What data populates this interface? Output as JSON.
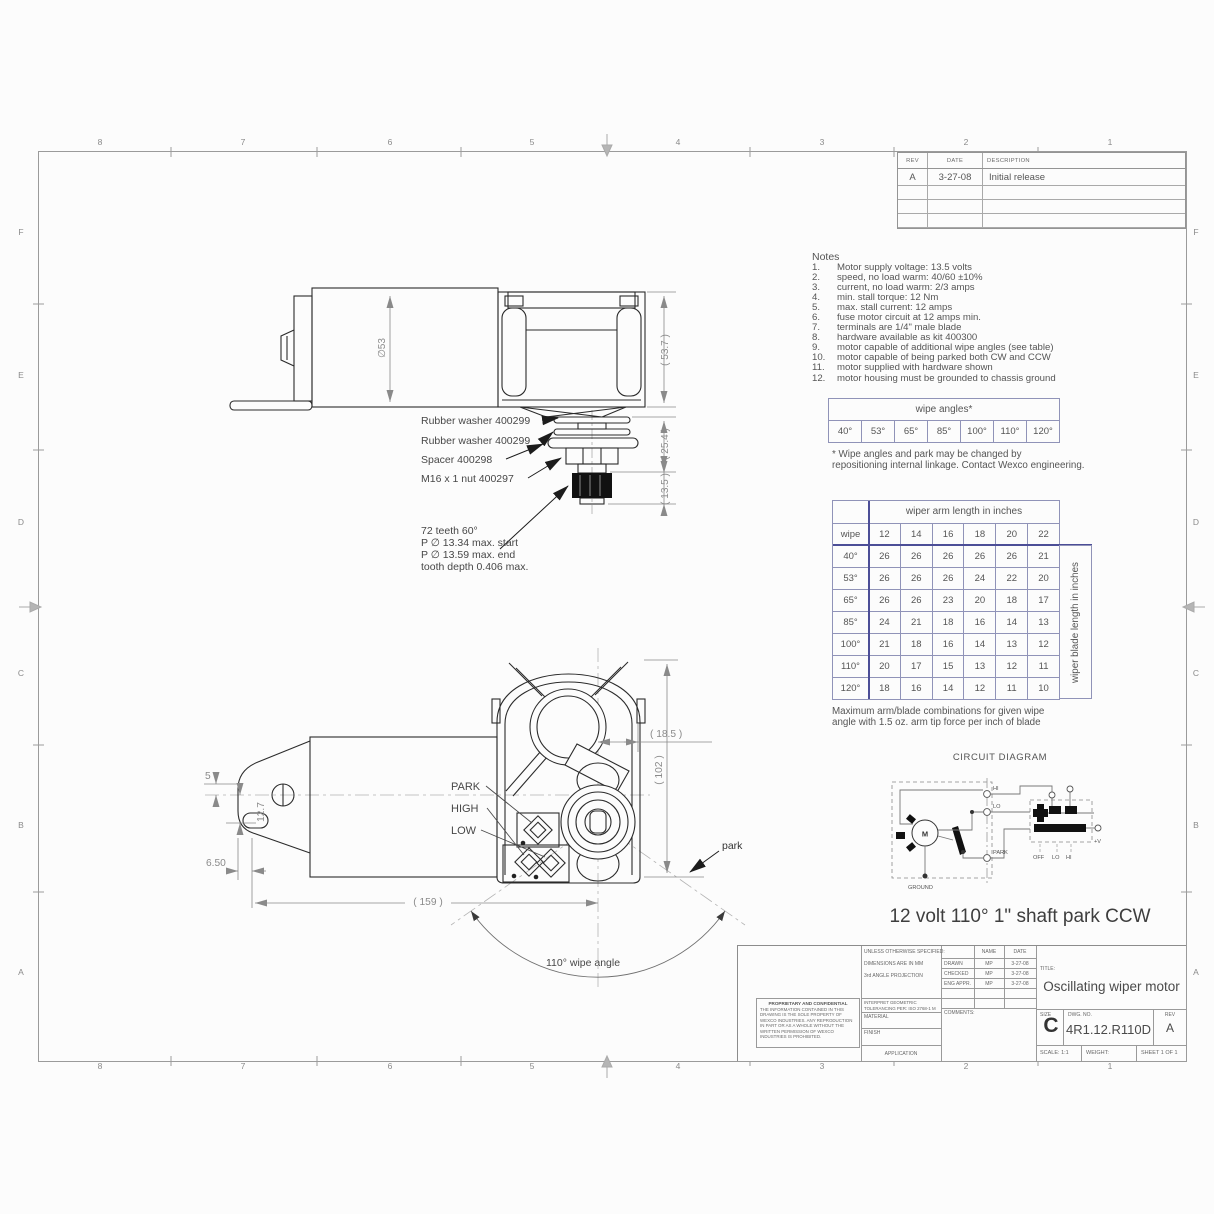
{
  "zones": {
    "top": [
      "8",
      "7",
      "6",
      "5",
      "4",
      "3",
      "2",
      "1"
    ],
    "bottom": [
      "8",
      "7",
      "6",
      "5",
      "4",
      "3",
      "2",
      "1"
    ],
    "left": [
      "F",
      "E",
      "D",
      "C",
      "B",
      "A"
    ],
    "right": [
      "F",
      "E",
      "D",
      "C",
      "B",
      "A"
    ]
  },
  "rev_table": {
    "headers": [
      "REV",
      "DATE",
      "DESCRIPTION"
    ],
    "rows": [
      [
        "A",
        "3-27-08",
        "Initial release"
      ]
    ],
    "empty_rows": 3
  },
  "notes": {
    "heading": "Notes",
    "items": [
      "Motor supply voltage: 13.5 volts",
      "speed, no load warm: 40/60 ±10%",
      "current, no load warm: 2/3 amps",
      "min. stall torque: 12 Nm",
      "max. stall current: 12 amps",
      "fuse motor circuit at 12 amps min.",
      "terminals are 1/4\" male blade",
      "hardware available as kit 400300",
      "motor capable of additional wipe angles (see table)",
      "motor capable of being parked both CW and CCW",
      "motor supplied with hardware shown",
      "motor housing must be grounded to chassis ground"
    ]
  },
  "wipe_table": {
    "title": "wipe angles*",
    "angles": [
      "40°",
      "53°",
      "65°",
      "85°",
      "100°",
      "110°",
      "120°"
    ]
  },
  "wipe_footnote_1": "* Wipe angles and park may be changed by",
  "wipe_footnote_2": "repositioning internal linkage. Contact Wexco engineering.",
  "arm_table": {
    "header": "wiper arm length in inches",
    "col0": "wipe",
    "cols": [
      "12",
      "14",
      "16",
      "18",
      "20",
      "22"
    ],
    "side": "wiper blade length in inches",
    "rows": [
      {
        "wipe": "40°",
        "v": [
          "26",
          "26",
          "26",
          "26",
          "26",
          "21"
        ]
      },
      {
        "wipe": "53°",
        "v": [
          "26",
          "26",
          "26",
          "24",
          "22",
          "20"
        ]
      },
      {
        "wipe": "65°",
        "v": [
          "26",
          "26",
          "23",
          "20",
          "18",
          "17"
        ]
      },
      {
        "wipe": "85°",
        "v": [
          "24",
          "21",
          "18",
          "16",
          "14",
          "13"
        ]
      },
      {
        "wipe": "100°",
        "v": [
          "21",
          "18",
          "16",
          "14",
          "13",
          "12"
        ]
      },
      {
        "wipe": "110°",
        "v": [
          "20",
          "17",
          "15",
          "13",
          "12",
          "11"
        ]
      },
      {
        "wipe": "120°",
        "v": [
          "18",
          "16",
          "14",
          "12",
          "11",
          "10"
        ]
      }
    ]
  },
  "arm_caption_1": "Maximum arm/blade combinations for given wipe",
  "arm_caption_2": "angle with 1.5 oz. arm tip force per inch of blade",
  "circuit": {
    "title": "CIRCUIT DIAGRAM",
    "hi": "HI",
    "lo": "LO",
    "park": "PARK",
    "ground": "GROUND",
    "motor": "M",
    "off": "OFF",
    "sw_lo": "LO",
    "sw_hi": "HI",
    "plus_v": "+V"
  },
  "subtitle": "12 volt 110° 1\" shaft park CCW",
  "top_view": {
    "dia": "∅53",
    "d537": "( 53.7 )",
    "d254": "( 25.4 )",
    "d135": "( 13.5 )",
    "lbl_washer1": "Rubber washer 400299",
    "lbl_washer2": "Rubber washer 400299",
    "lbl_spacer": "Spacer 400298",
    "lbl_nut": "M16 x 1 nut 400297",
    "teeth_1": "72 teeth 60°",
    "teeth_2": "P ∅  13.34 max. start",
    "teeth_3": "P ∅  13.59 max. end",
    "teeth_4": "tooth depth 0.406 max."
  },
  "front_view": {
    "d5": "5",
    "d127": "12.7",
    "d650": "6.50",
    "d159": "( 159 )",
    "d185": "( 18.5 )",
    "d102": "( 102 )",
    "park": "PARK",
    "high": "HIGH",
    "low": "LOW",
    "park_arrow": "park",
    "arc_label": "110° wipe angle"
  },
  "title_block": {
    "unless": "UNLESS OTHERWISE SPECIFIED:",
    "dims_mm": "DIMENSIONS ARE IN MM",
    "projection": "3rd ANGLE PROJECTION",
    "interpret_1": "INTERPRET GEOMETRIC",
    "interpret_2": "TOLERANCING PER: ISO 2768-1 M",
    "material": "MATERIAL",
    "finish": "FINISH",
    "application": "APPLICATION",
    "name_h": "NAME",
    "date_h": "DATE",
    "approvals": [
      {
        "label": "DRAWN",
        "name": "MP",
        "date": "3-27-08"
      },
      {
        "label": "CHECKED",
        "name": "MP",
        "date": "3-27-08"
      },
      {
        "label": "ENG APPR.",
        "name": "MP",
        "date": "3-27-08"
      }
    ],
    "comments": "COMMENTS:",
    "title_label": "TITLE:",
    "title": "Oscillating wiper motor",
    "size_label": "SIZE",
    "size": "C",
    "dwg_label": "DWG.  NO.",
    "dwg": "4R1.12.R110D",
    "rev_label": "REV",
    "rev": "A",
    "scale": "SCALE: 1:1",
    "weight": "WEIGHT:",
    "sheet": "SHEET 1 OF 1",
    "prop_title": "PROPRIETARY AND CONFIDENTIAL",
    "prop_body": "THE INFORMATION CONTAINED IN THIS DRAWING IS THE SOLE PROPERTY OF WEXCO INDUSTRIES.  ANY REPRODUCTION IN PART OR AS A WHOLE WITHOUT THE WRITTEN PERMISSION OF WEXCO INDUSTRIES IS PROHIBITED."
  }
}
